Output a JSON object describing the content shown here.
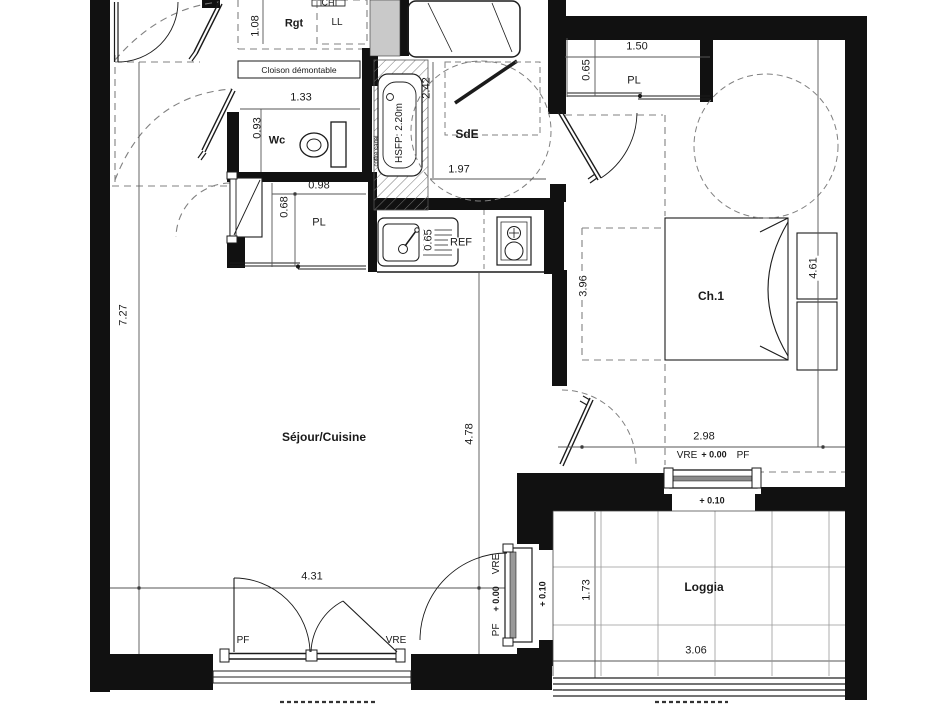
{
  "entry": {
    "storage": "Rgt",
    "washer": "LL",
    "water_heater": "CH",
    "partition": "Cloison démontable",
    "dim_width": "1.08"
  },
  "wc": {
    "label": "Wc",
    "dim_width": "1.33",
    "dim_depth": "0.93"
  },
  "hall_closet": {
    "label": "PL",
    "dim_width": "0.98",
    "dim_depth": "0.68"
  },
  "shower_room": {
    "label": "SdE",
    "dim_depth": "2.42",
    "dim_width": "1.97",
    "ceiling_height": "HSFP: 2.20m",
    "duct": "coffre canal"
  },
  "kitchen": {
    "fridge": "REF",
    "dim_counter": "0.65"
  },
  "bedroom": {
    "label": "Ch.1",
    "closet": "PL",
    "closet_width": "1.50",
    "closet_depth": "0.65",
    "dim_depth": "3.96",
    "dim_width": "4.61",
    "dim_opening": "2.98",
    "window": "VRE",
    "level": "+ 0.00",
    "window2": "PF"
  },
  "living": {
    "label": "Séjour/Cuisine",
    "dim_depth": "7.27",
    "dim_mid": "4.78",
    "dim_opening": "4.31",
    "window_pf": "PF",
    "window_vre": "VRE"
  },
  "loggia_door": {
    "pf": "PF",
    "level": "+ 0.00",
    "vre": "VRE",
    "threshold": "+ 0.10"
  },
  "loggia": {
    "label": "Loggia",
    "dim_depth": "1.73",
    "dim_width": "3.06",
    "level": "+ 0.10"
  }
}
